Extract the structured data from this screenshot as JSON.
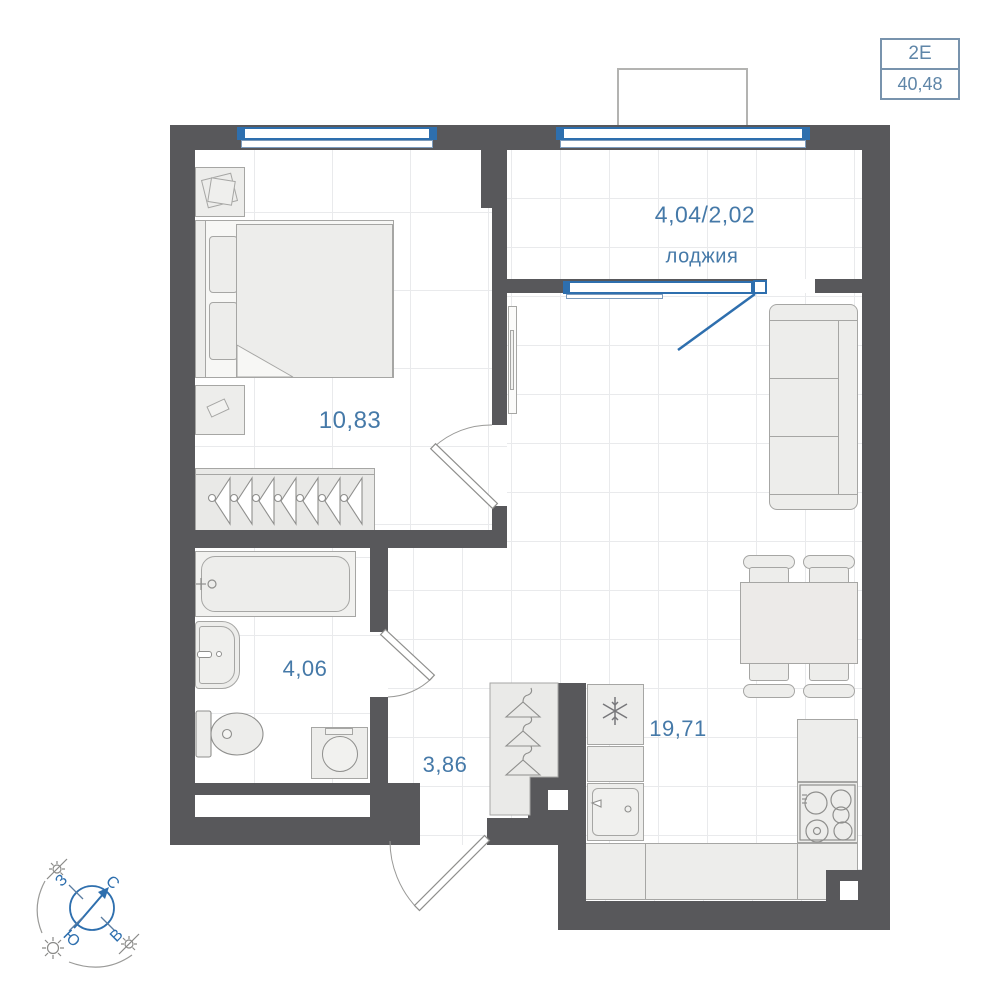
{
  "badge": {
    "unit_type": "2Е",
    "total_area": "40,48"
  },
  "rooms": {
    "loggia": {
      "area": "4,04/2,02",
      "label": "лоджия"
    },
    "bedroom": {
      "area": "10,83"
    },
    "bathroom": {
      "area": "4,06"
    },
    "hallway": {
      "area": "3,86"
    },
    "kitchen_living": {
      "area": "19,71"
    }
  },
  "compass": {
    "north": "С",
    "east": "В",
    "south": "Ю",
    "west": "З"
  },
  "colors": {
    "wall": "#58585b",
    "window_accent": "#2e6fae",
    "label_text": "#4579a8",
    "badge_accent": "#7893ad",
    "furniture_fill": "#ededeb",
    "furniture_stroke": "#a6a6a4",
    "grid_line": "#e9eaec"
  }
}
